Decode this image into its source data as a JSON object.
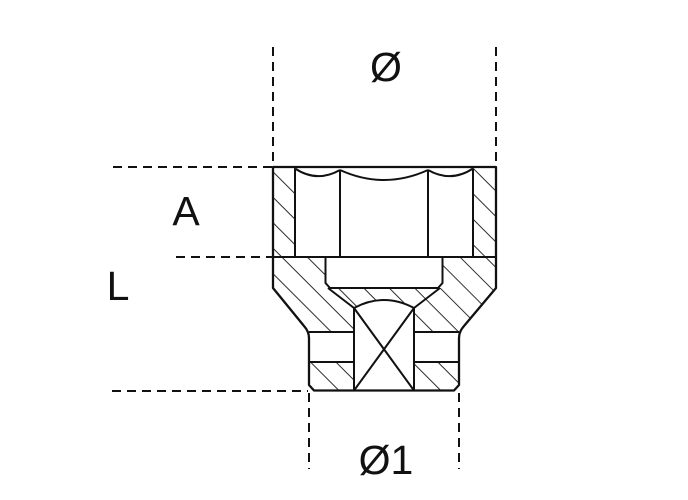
{
  "drawing": {
    "type_description": "socket cross-section technical drawing",
    "labels": {
      "outer_diameter": "Ø",
      "opening_depth": "A",
      "total_length": "L",
      "drive_end_diameter": "Ø1"
    },
    "colors": {
      "line": "#111111",
      "background": "#ffffff"
    }
  }
}
